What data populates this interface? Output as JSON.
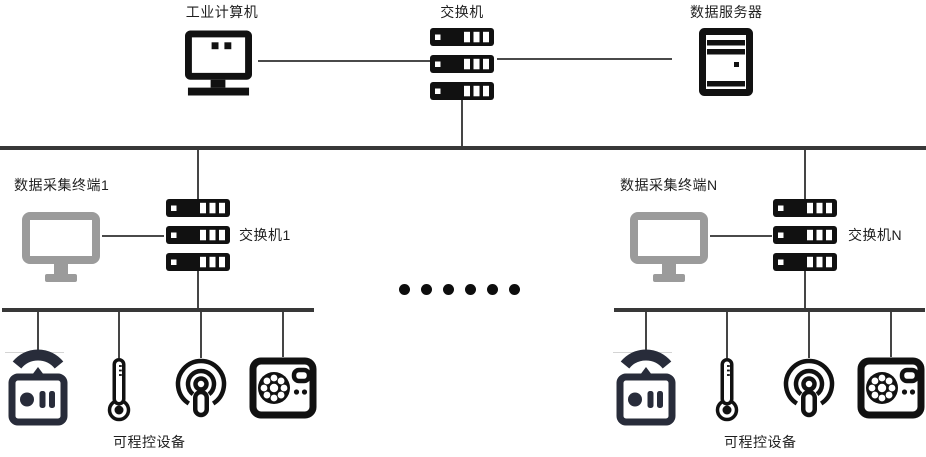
{
  "diagram": {
    "type": "network-topology",
    "background": "#ffffff",
    "labels": {
      "industrial_computer": "工业计算机",
      "main_switch": "交换机",
      "data_server": "数据服务器",
      "terminal_1": "数据采集终端1",
      "switch_1": "交换机1",
      "terminal_n": "数据采集终端N",
      "switch_n": "交换机N",
      "devices_left": "可程控设备",
      "devices_right": "可程控设备"
    },
    "icons": {
      "top_row": [
        "industrial-computer-icon",
        "switch-icon",
        "server-icon"
      ],
      "middle_row": [
        "terminal-monitor-icon",
        "switch-icon"
      ],
      "device_row": [
        "remote-control-icon",
        "thermometer-icon",
        "broadcast-icon",
        "control-panel-icon"
      ]
    },
    "colors": {
      "icon_black": "#111111",
      "remote_navy": "#282c3a",
      "terminal_gray": "#9b9b9b",
      "bus_line": "#383838",
      "connector_line": "#4a4a4a",
      "text": "#1f1f1f"
    },
    "ellipsis": {
      "count": 6
    }
  }
}
